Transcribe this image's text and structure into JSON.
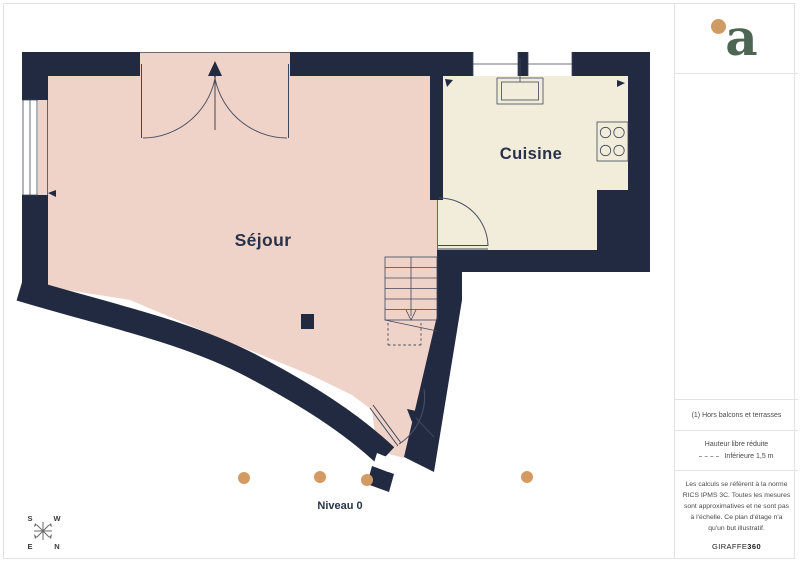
{
  "colors": {
    "wall": "#212a40",
    "sejour_fill": "#f0d3c8",
    "cuisine_fill": "#f2ecdb",
    "camera_dot": "#d49a63",
    "logo_green": "#4d6654",
    "logo_dot": "#cf9b64"
  },
  "plan": {
    "rooms": {
      "sejour": "Séjour",
      "cuisine": "Cuisine"
    },
    "level_label": "Niveau 0",
    "compass": {
      "n": "N",
      "s": "S",
      "e": "E",
      "w": "W"
    }
  },
  "sidebar": {
    "logo_letter": "a",
    "note_footnote": "(1) Hors balcons et terrasses",
    "reduced_height_title": "Hauteur libre réduite",
    "reduced_height_value": "Inférieure 1,5 m",
    "disclaimer": "Les calculs se réfèrent à la norme RICS IPMS 3C. Toutes les mesures sont approximatives et ne sont pas à l'échelle. Ce plan d'étage n'a qu'un but illustratif.",
    "brand_name": "GIRAFFE",
    "brand_suffix": "360"
  }
}
